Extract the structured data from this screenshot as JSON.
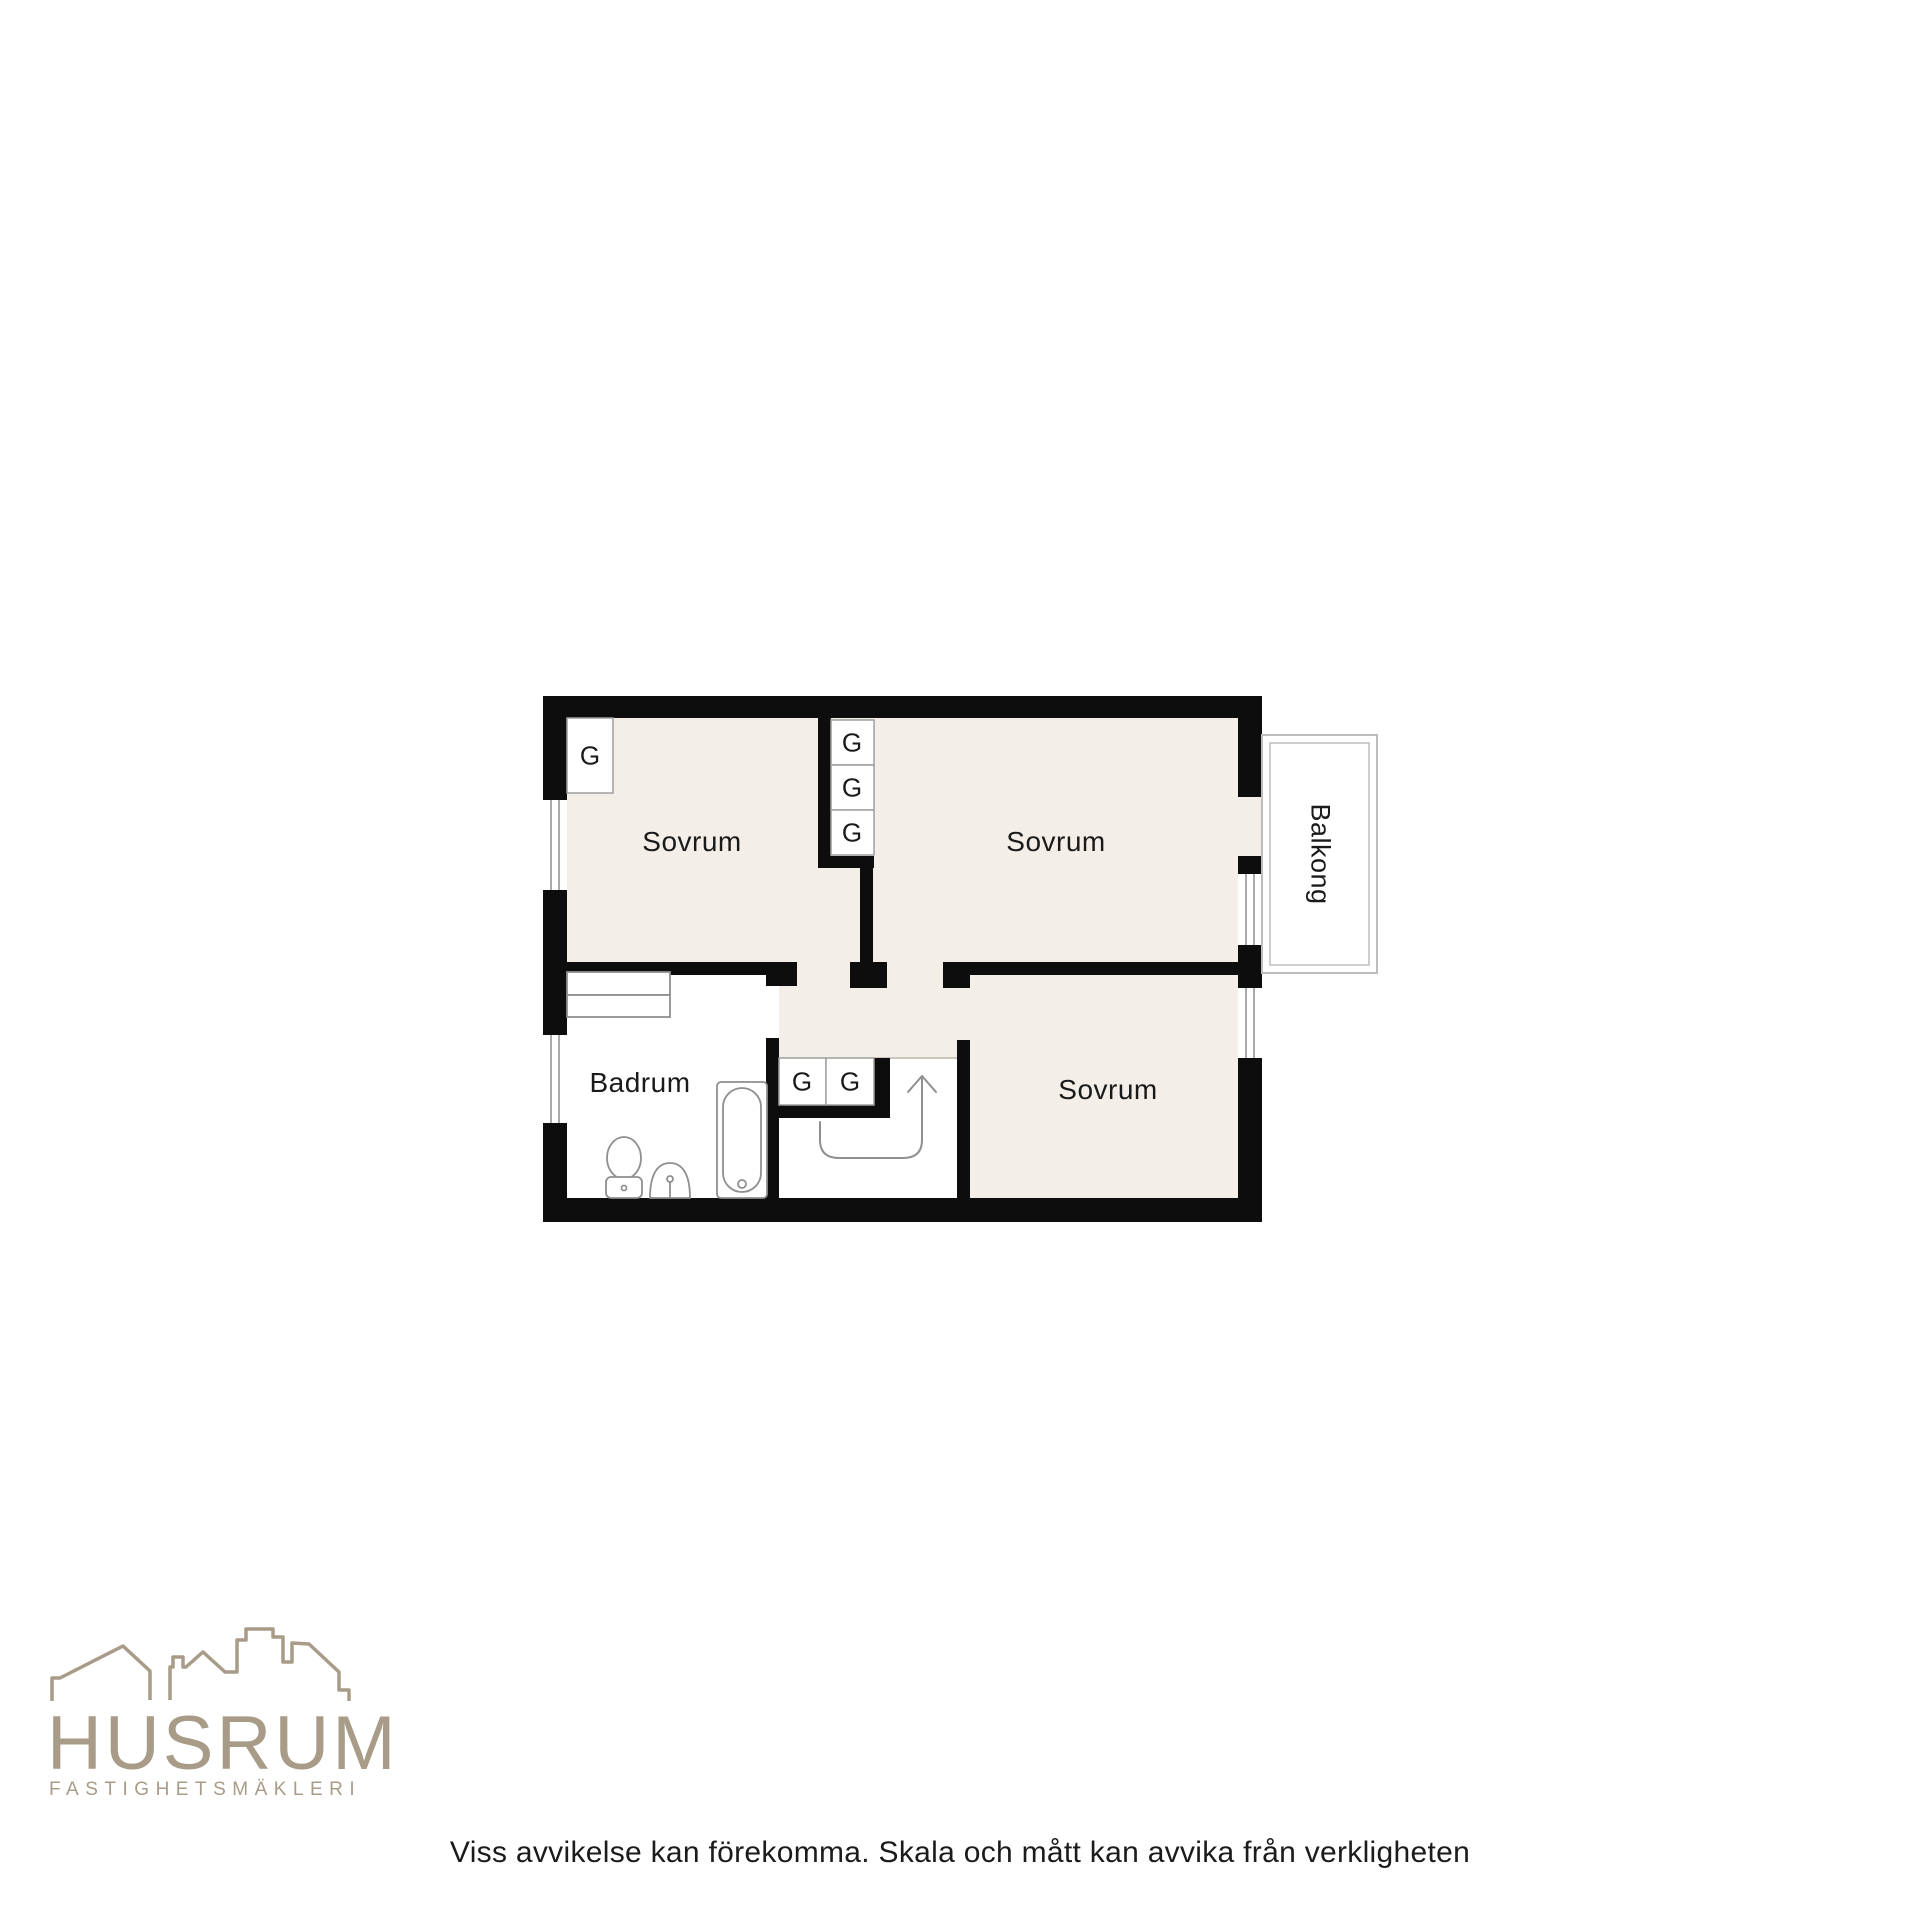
{
  "plan": {
    "rooms": {
      "sovrum_top_left": "Sovrum",
      "sovrum_top_right": "Sovrum",
      "sovrum_bottom": "Sovrum",
      "badrum": "Badrum",
      "balkong": "Balkong"
    },
    "closets": [
      "G",
      "G",
      "G",
      "G",
      "G",
      "G"
    ]
  },
  "branding": {
    "name": "HUSRUM",
    "tagline": "FASTIGHETSMÄKLERI"
  },
  "footer": {
    "disclaimer": "Viss avvikelse kan förekomma. Skala och mått kan avvika från verkligheten"
  },
  "colors": {
    "wall": "#0d0d0d",
    "floor": "#f3efe8",
    "fixture_line": "#8f8f8f",
    "balcony_line": "#bdbdbd",
    "brand": "#a89b88",
    "text": "#1a1a1a"
  }
}
